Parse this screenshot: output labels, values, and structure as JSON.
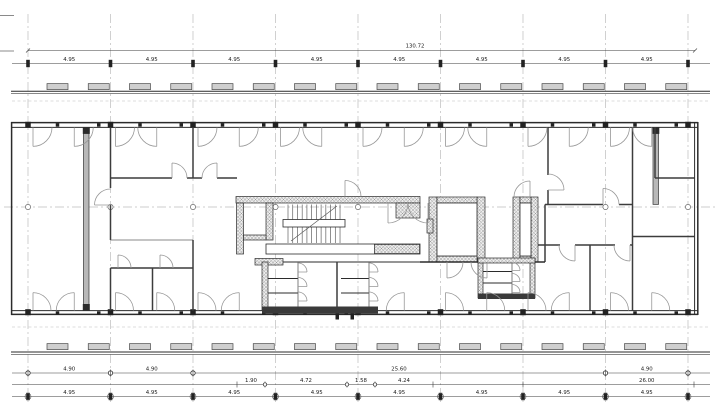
{
  "drawing": {
    "kind": "architectural floor plan - storey plan with dimension chains",
    "background": "#ffffff",
    "ink_color": "#2b2b2b",
    "wall_fill_color": "#b8b8b8",
    "hatch_color": "#8f8f8f"
  },
  "grid": {
    "column_count": 9
  },
  "dimensions": {
    "top_total": {
      "label": "130.72"
    },
    "top_chain": {
      "labels": [
        "4.95",
        "4.95",
        "4.95",
        "4.95",
        "4.95",
        "4.95",
        "4.95",
        "4.95"
      ]
    },
    "bottom_chain_a": {
      "labels": [
        "4.90",
        "4.90",
        "25.60",
        "4.90"
      ]
    },
    "bottom_chain_b": {
      "labels": [
        "1.90",
        "4.72",
        "1.58",
        "4.24",
        "26.00"
      ]
    },
    "bottom_chain_c": {
      "labels": [
        "4.95",
        "4.95",
        "4.95",
        "4.95",
        "4.95",
        "4.95",
        "4.95",
        "4.95"
      ]
    }
  }
}
